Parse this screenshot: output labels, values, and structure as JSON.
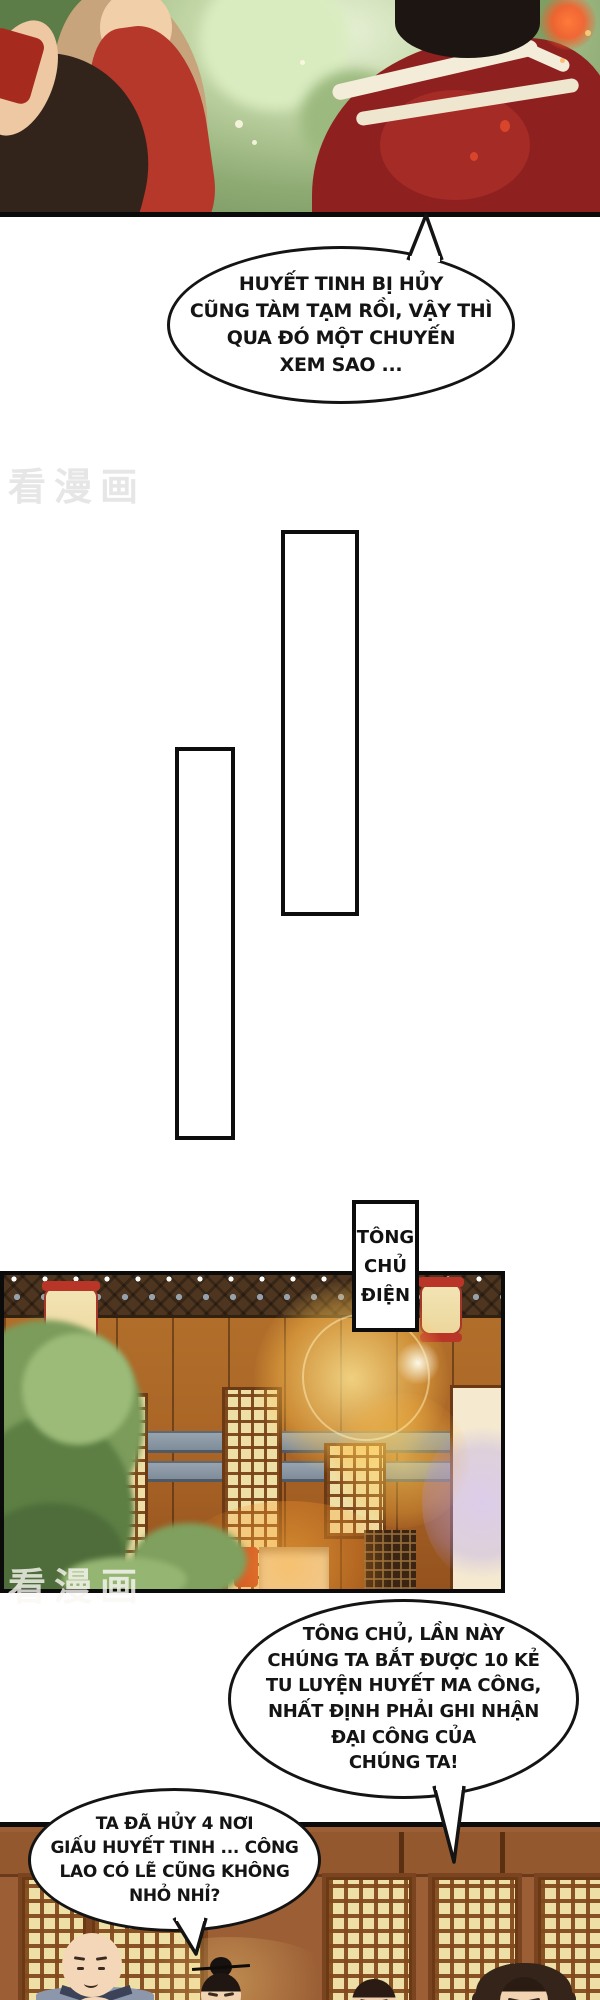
{
  "comic": {
    "bubble1": {
      "lines": [
        "HUYẾT TINH BỊ HỦY",
        "CŨNG TÀM TẠM RỒI, VẬY THÌ",
        "QUA ĐÓ MỘT CHUYẾN",
        "XEM SAO ..."
      ]
    },
    "bubble2": {
      "lines": [
        "TÔNG CHỦ, LẦN NÀY",
        "CHÚNG TA BẮT ĐƯỢC 10 KẺ",
        "TU LUYỆN HUYẾT MA CÔNG,",
        "NHẤT ĐỊNH PHẢI GHI NHẬN",
        "ĐẠI CÔNG CỦA",
        "CHÚNG TA!"
      ]
    },
    "bubble3": {
      "lines": [
        "TA ĐÃ HỦY 4 NƠI",
        "GIẤU HUYẾT TINH ... CÔNG",
        "LAO CÓ LẼ CŨNG KHÔNG",
        "NHỎ NHỈ?"
      ]
    },
    "sign": {
      "lines": [
        "TÔNG",
        "CHỦ",
        "ĐIỆN"
      ]
    },
    "watermark": "看漫画",
    "colors": {
      "panel_border": "#0b0b0b",
      "bubble_fill": "#ffffff",
      "bubble_border": "#141414",
      "watermark_gray": "#e6e6e6",
      "palace_wood": "#b3712c",
      "lattice_cream": "#eedfa6",
      "lattice_frame": "#6b3a14",
      "bottom_wall": "#9c5f35",
      "robe_red": "#8e2120",
      "dress_red": "#b5382b",
      "foliage_green": "#7b9c5b",
      "monk_robe": "#8d97ac",
      "flare_gold": "#ffd768"
    }
  }
}
